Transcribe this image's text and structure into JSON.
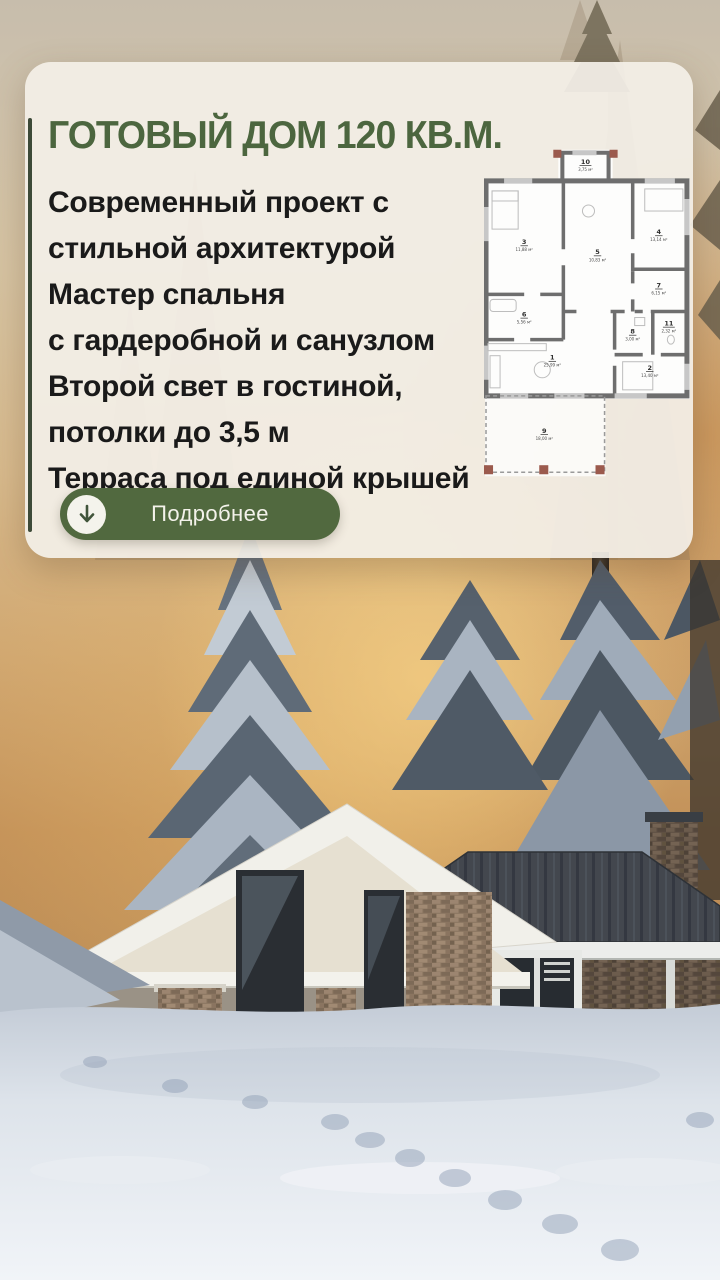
{
  "card": {
    "title": "ГОТОВЫЙ ДОМ 120 КВ.М.",
    "description_lines": [
      "Современный проект с",
      "стильной архитектурой",
      "Мастер спальня",
      "с гардеробной и санузлом",
      "Второй свет в гостиной,",
      "потолки до 3,5 м",
      "Терраса под единой крышей"
    ],
    "button": {
      "label": "Подробнее",
      "icon": "arrow-down-icon"
    }
  },
  "floor_plan": {
    "unit": "м²",
    "rooms": [
      {
        "id": "1",
        "area": "25,99 м²"
      },
      {
        "id": "2",
        "area": "13,40 м²"
      },
      {
        "id": "3",
        "area": "11,88 м²"
      },
      {
        "id": "4",
        "area": "13,14 м²"
      },
      {
        "id": "5",
        "area": "10,83 м²"
      },
      {
        "id": "6",
        "area": "5,56 м²"
      },
      {
        "id": "7",
        "area": "6,15 м²"
      },
      {
        "id": "8",
        "area": "3,00 м²"
      },
      {
        "id": "9",
        "area": "18,00 м²"
      },
      {
        "id": "10",
        "area": "3,75 м²"
      },
      {
        "id": "11",
        "area": "2,32 м²"
      }
    ]
  },
  "colors": {
    "accent_green": "#4c663f",
    "button_green": "#51693f",
    "card_background": "#f3efe7",
    "body_text": "#1a1a1a",
    "plan_wall": "#6e6e6e",
    "plan_post_brown": "#9b5a4d"
  }
}
